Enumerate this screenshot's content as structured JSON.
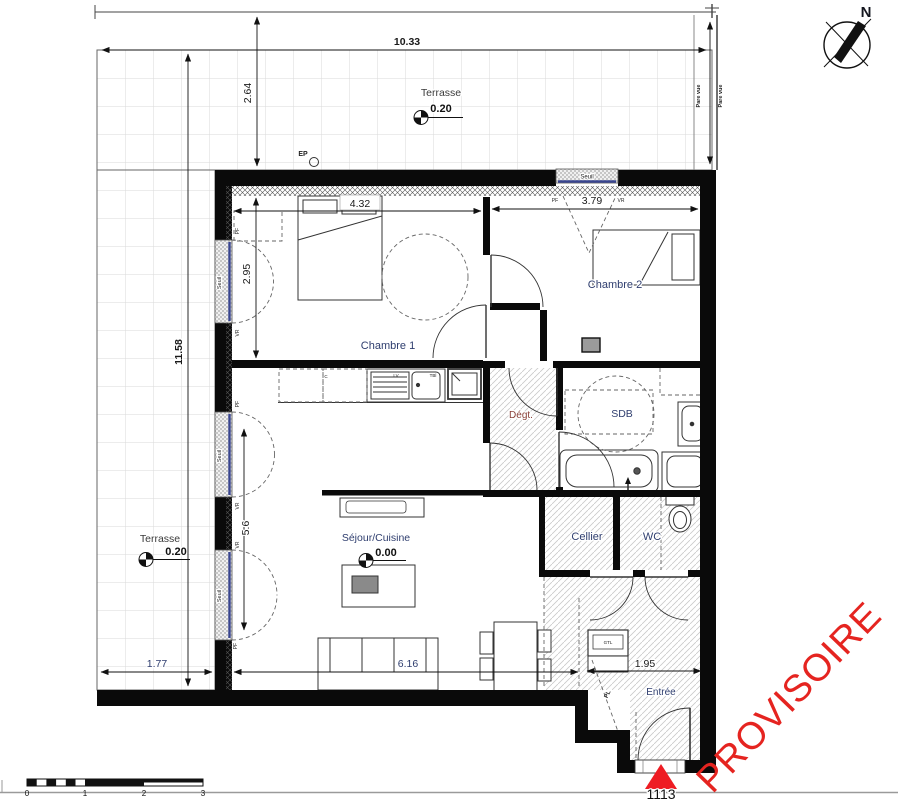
{
  "stamp": {
    "text": "PROVISOIRE"
  },
  "lot": {
    "number": "1113"
  },
  "north": {
    "label": "N"
  },
  "rooms": {
    "chambre1": "Chambre 1",
    "chambre2": "Chambre 2",
    "sdb": "SDB",
    "degt": "Dégt.",
    "cellier": "Cellier",
    "wc": "WC",
    "entree": "Entrée",
    "sejour": "Séjour/Cuisine",
    "terrasse": "Terrasse"
  },
  "levels": {
    "sejour": "0.00",
    "terrasse": "0.20"
  },
  "dims": {
    "overall_width": "10.33",
    "terrace_depth": "2.64",
    "overall_height": "11.58",
    "chambre1_width": "4.32",
    "chambre1_height": "2.95",
    "chambre2_width": "3.79",
    "sejour_height": "5.6",
    "terrace_bottom_width": "1.77",
    "sejour_width": "6.16",
    "entree_width": "1.95"
  },
  "labels": {
    "seuil": "Seuil",
    "pare_vue": "Pare vue",
    "ep": "EP",
    "pf": "PF",
    "vr": "VR",
    "gtl": "GTL",
    "pl": "PL",
    "lv": "LV",
    "tbl": "TBl",
    "c": "C"
  },
  "scale_bar": {
    "t0": "0",
    "t1": "1",
    "t2": "2",
    "t3": "3"
  },
  "colors": {
    "stamp_red": "#e52420",
    "marker_red": "#ee1c23",
    "room_label": "#2e3d6e",
    "degt_label": "#8a4038",
    "glass_blue": "#39458f",
    "wall": "#000000"
  }
}
